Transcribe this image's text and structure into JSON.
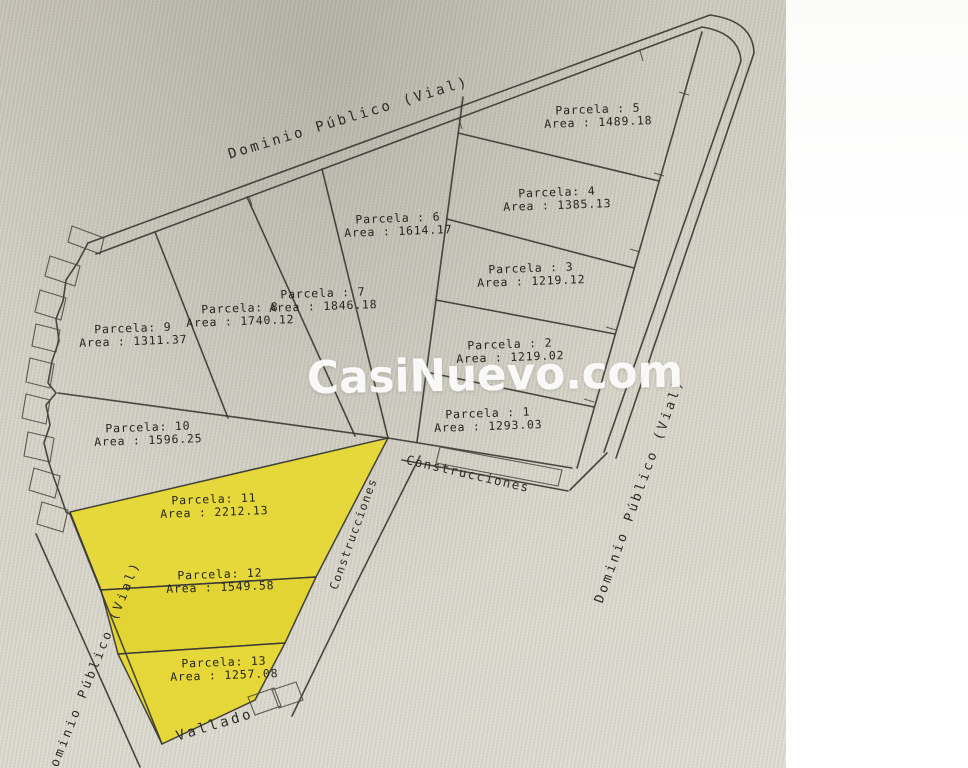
{
  "watermark": "CasiNuevo.com",
  "colors": {
    "highlight_yellow": "#e5d72f",
    "paper": "#d5d2c6",
    "line": "#3c3b33",
    "margin": "#ffffff",
    "watermark_text": "#ffffff"
  },
  "labels": {
    "road_top": "Dominio Público (Vial)",
    "road_right": "Dominio Público (Vial)",
    "road_left": "Dominio Público (Vial)",
    "fence": "Vallado",
    "constructions_strip": "Construcciones",
    "constructions_band": "Construcciones"
  },
  "parcels": [
    {
      "id": 1,
      "label": "Parcela : 1",
      "area": "Area : 1293.03",
      "highlighted": false
    },
    {
      "id": 2,
      "label": "Parcela : 2",
      "area": "Area : 1219.02",
      "highlighted": false
    },
    {
      "id": 3,
      "label": "Parcela : 3",
      "area": "Area : 1219.12",
      "highlighted": false
    },
    {
      "id": 4,
      "label": "Parcela: 4",
      "area": "Area : 1385.13",
      "highlighted": false
    },
    {
      "id": 5,
      "label": "Parcela : 5",
      "area": "Area : 1489.18",
      "highlighted": false
    },
    {
      "id": 6,
      "label": "Parcela : 6",
      "area": "Area : 1614.17",
      "highlighted": false
    },
    {
      "id": 7,
      "label": "Parcela : 7",
      "area": "Area : 1846.18",
      "highlighted": false
    },
    {
      "id": 8,
      "label": "Parcela: 8",
      "area": "Area : 1740.12",
      "highlighted": false
    },
    {
      "id": 9,
      "label": "Parcela: 9",
      "area": "Area : 1311.37",
      "highlighted": false
    },
    {
      "id": 10,
      "label": "Parcela: 10",
      "area": "Area : 1596.25",
      "highlighted": false
    },
    {
      "id": 11,
      "label": "Parcela: 11",
      "area": "Area : 2212.13",
      "highlighted": true
    },
    {
      "id": 12,
      "label": "Parcela: 12",
      "area": "Area : 1549.58",
      "highlighted": true
    },
    {
      "id": 13,
      "label": "Parcela: 13",
      "area": "Area : 1257.08",
      "highlighted": true
    }
  ]
}
